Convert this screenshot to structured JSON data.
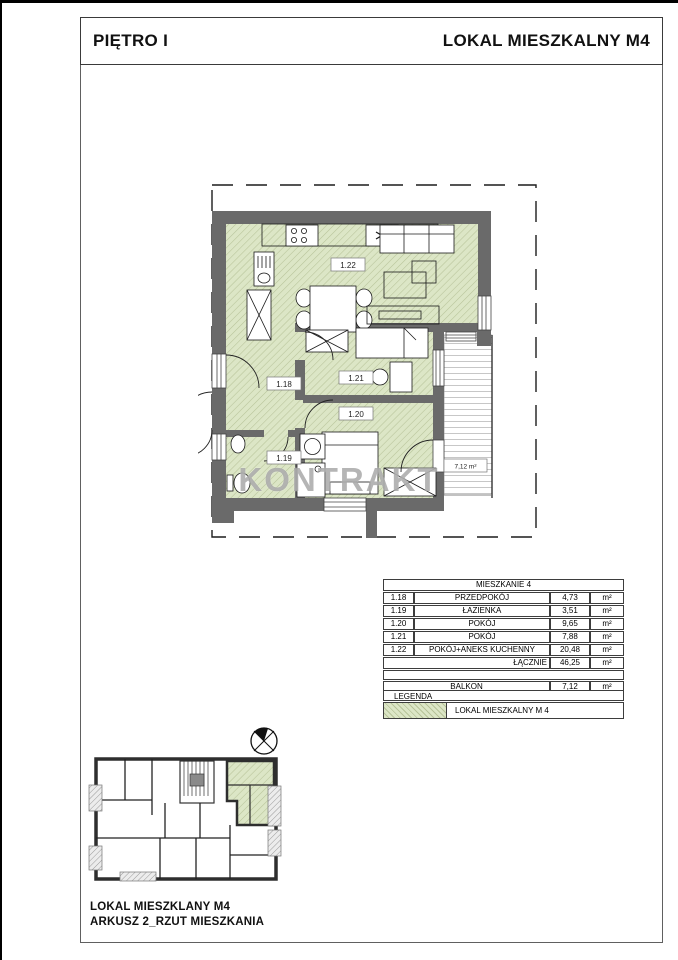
{
  "header": {
    "floor": "PIĘTRO I",
    "unit": "LOKAL MIESZKALNY M4"
  },
  "plan": {
    "watermark": "KONTRAKT",
    "room_labels": {
      "r118": "1.18",
      "r119": "1.19",
      "r120": "1.20",
      "r121": "1.21",
      "r122": "1.22"
    },
    "balcony_area_label": "7,12 m²"
  },
  "area_table": {
    "title": "MIESZKANIE 4",
    "rows": [
      {
        "id": "1.18",
        "name": "PRZEDPOKÓJ",
        "area": "4,73",
        "unit": "m²"
      },
      {
        "id": "1.19",
        "name": "ŁAZIENKA",
        "area": "3,51",
        "unit": "m²"
      },
      {
        "id": "1.20",
        "name": "POKÓJ",
        "area": "9,65",
        "unit": "m²"
      },
      {
        "id": "1.21",
        "name": "POKÓJ",
        "area": "7,88",
        "unit": "m²"
      },
      {
        "id": "1.22",
        "name": "POKÓJ+ANEKS KUCHENNY",
        "area": "20,48",
        "unit": "m²"
      }
    ],
    "total_label": "ŁĄCZNIE",
    "total_area": "46,25",
    "total_unit": "m²",
    "balcony_label": "BALKON",
    "balcony_area": "7,12",
    "balcony_unit": "m²"
  },
  "legend": {
    "title": "LEGENDA",
    "item": "LOKAL MIESZKALNY M 4"
  },
  "footer": {
    "line1": "LOKAL MIESZKLANY M4",
    "line2": "ARKUSZ 2_RZUT MIESZKANIA"
  },
  "colors": {
    "wall": "#6a6a6a",
    "unit_fill": "#dce6c6",
    "unit_hatch": "#b7c399"
  }
}
